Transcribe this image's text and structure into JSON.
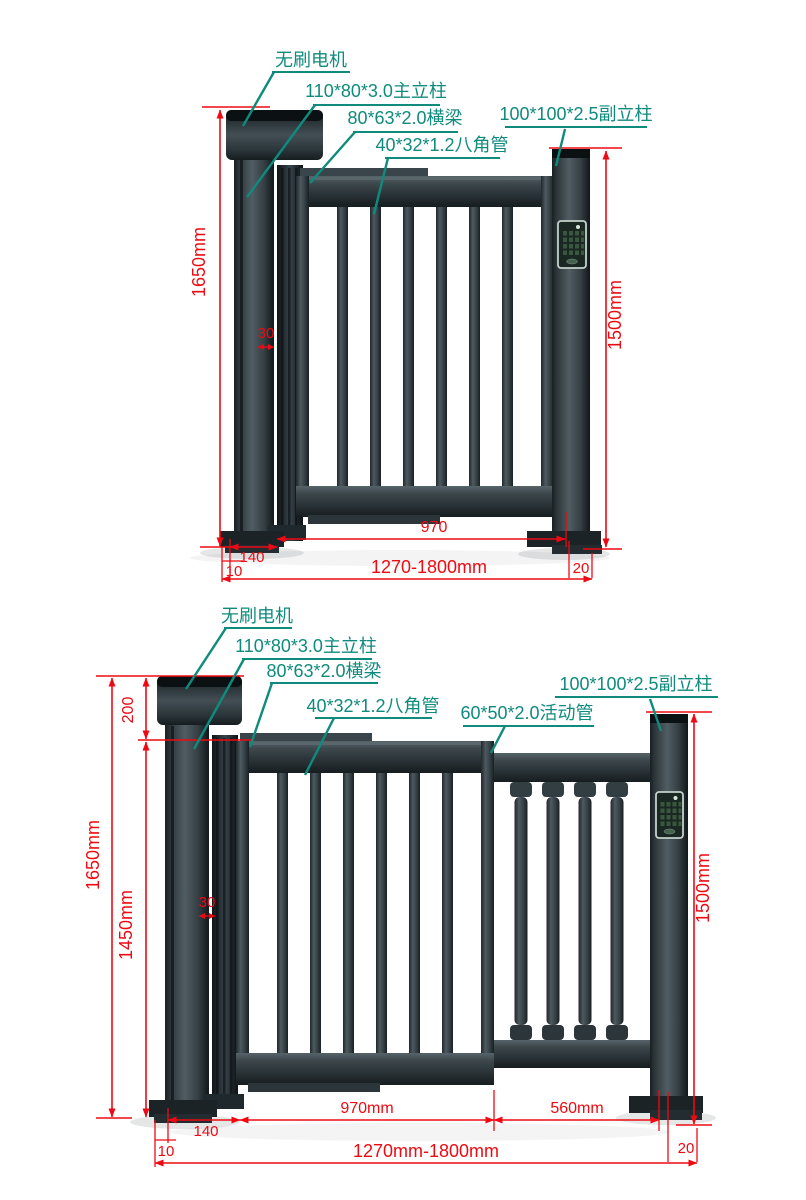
{
  "page": {
    "background": "#ffffff"
  },
  "colors": {
    "label_teal": "#0f8b7d",
    "dimension_red": "#ee0a12",
    "metal_dark": "#1d2427",
    "metal_mid": "#3d484d",
    "metal_light": "#5a676c"
  },
  "top_diagram": {
    "labels": {
      "motor": "无刷电机",
      "main_post": "110*80*3.0主立柱",
      "beam": "80*63*2.0横梁",
      "octagonal_tube": "40*32*1.2八角管",
      "aux_post": "100*100*2.5副立柱"
    },
    "dims": {
      "total_height": "1650mm",
      "aux_post_height": "1500mm",
      "leaf_width": "970",
      "post_offset": "140",
      "base_left": "10",
      "width_range": "1270-1800mm",
      "base_right": "20",
      "gap": "30"
    }
  },
  "bottom_diagram": {
    "labels": {
      "motor": "无刷电机",
      "main_post": "110*80*3.0主立柱",
      "beam": "80*63*2.0横梁",
      "octagonal_tube": "40*32*1.2八角管",
      "movable_tube": "60*50*2.0活动管",
      "aux_post": "100*100*2.5副立柱"
    },
    "dims": {
      "total_height": "1650mm",
      "leaf_height": "1450mm",
      "motor_height": "200",
      "aux_post_height": "1500mm",
      "leaf_width": "970mm",
      "movable_width": "560mm",
      "post_offset": "140",
      "base_left": "10",
      "width_range": "1270mm-1800mm",
      "base_right": "20",
      "gap": "30"
    }
  }
}
